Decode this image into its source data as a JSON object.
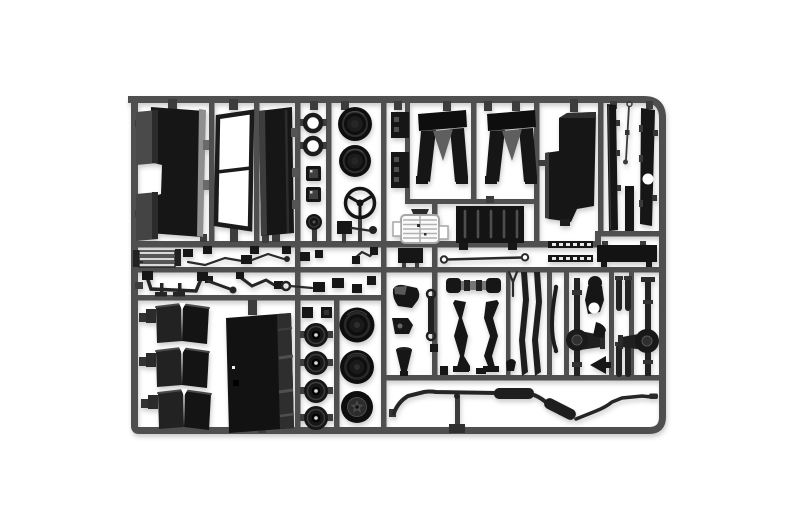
{
  "scene": {
    "type": "product-photograph",
    "description": "Black injection-molded model-kit sprue (parts tree) with truck model parts, photographed on a seamless white background",
    "background_color": "#ffffff",
    "colors": {
      "runner_gray": "#4f4f4f",
      "part_black": "#161616",
      "part_mid_gray": "#2e2e2e",
      "part_light_gray": "#8f8f8f",
      "grille_light": "#aaaaaa",
      "white_background": "#ffffff"
    }
  },
  "sprue": {
    "frame_shape": "rounded rectangle runner frame with internal rails",
    "parts_inventory": [
      {
        "name": "cab-back-panel",
        "count": 1
      },
      {
        "name": "window-frame",
        "count": 1
      },
      {
        "name": "door-panel",
        "count": 1
      },
      {
        "name": "sealing-ring",
        "count": 2
      },
      {
        "name": "front-tire",
        "count": 2
      },
      {
        "name": "instrument-box",
        "count": 2
      },
      {
        "name": "steering-wheel",
        "count": 1
      },
      {
        "name": "horn-disc",
        "count": 1
      },
      {
        "name": "pedal-arm-bracket",
        "count": 1
      },
      {
        "name": "step-plate",
        "count": 2
      },
      {
        "name": "mudguard",
        "count": 2
      },
      {
        "name": "radiator-grille",
        "count": 1
      },
      {
        "name": "louvre-panel",
        "count": 1
      },
      {
        "name": "bumper-plate",
        "count": 1
      },
      {
        "name": "tie-rod",
        "count": 1
      },
      {
        "name": "cab-side-panel",
        "count": 1
      },
      {
        "name": "chassis-strip",
        "count": 3
      },
      {
        "name": "brake-rod",
        "count": 1
      },
      {
        "name": "leaf-spring-stack",
        "count": 1
      },
      {
        "name": "linkage-rod",
        "count": 4
      },
      {
        "name": "pedal-bracket",
        "count": 1
      },
      {
        "name": "gear-lever",
        "count": 2
      },
      {
        "name": "ladder-strip",
        "count": 2
      },
      {
        "name": "sill-plate",
        "count": 1
      },
      {
        "name": "engine-mount",
        "count": 1
      },
      {
        "name": "funnel-bell",
        "count": 1
      },
      {
        "name": "wrench-link",
        "count": 1
      },
      {
        "name": "front-axle-beam",
        "count": 1
      },
      {
        "name": "steering-knuckle",
        "count": 2
      },
      {
        "name": "spring-shaft",
        "count": 2
      },
      {
        "name": "leaf-spring-arc",
        "count": 1
      },
      {
        "name": "axle-with-differential",
        "count": 2
      },
      {
        "name": "crank-bracket",
        "count": 1
      },
      {
        "name": "air-tank-pair",
        "count": 2
      },
      {
        "name": "funnel-chute",
        "count": 1
      },
      {
        "name": "mudflap",
        "count": 3
      },
      {
        "name": "cargo-panel",
        "count": 1
      },
      {
        "name": "wheel-hub",
        "count": 4
      },
      {
        "name": "rear-tire",
        "count": 2
      },
      {
        "name": "spare-wheel-star-hub",
        "count": 1
      },
      {
        "name": "exhaust-system",
        "count": 1
      },
      {
        "name": "exhaust-hanger",
        "count": 1
      }
    ]
  }
}
